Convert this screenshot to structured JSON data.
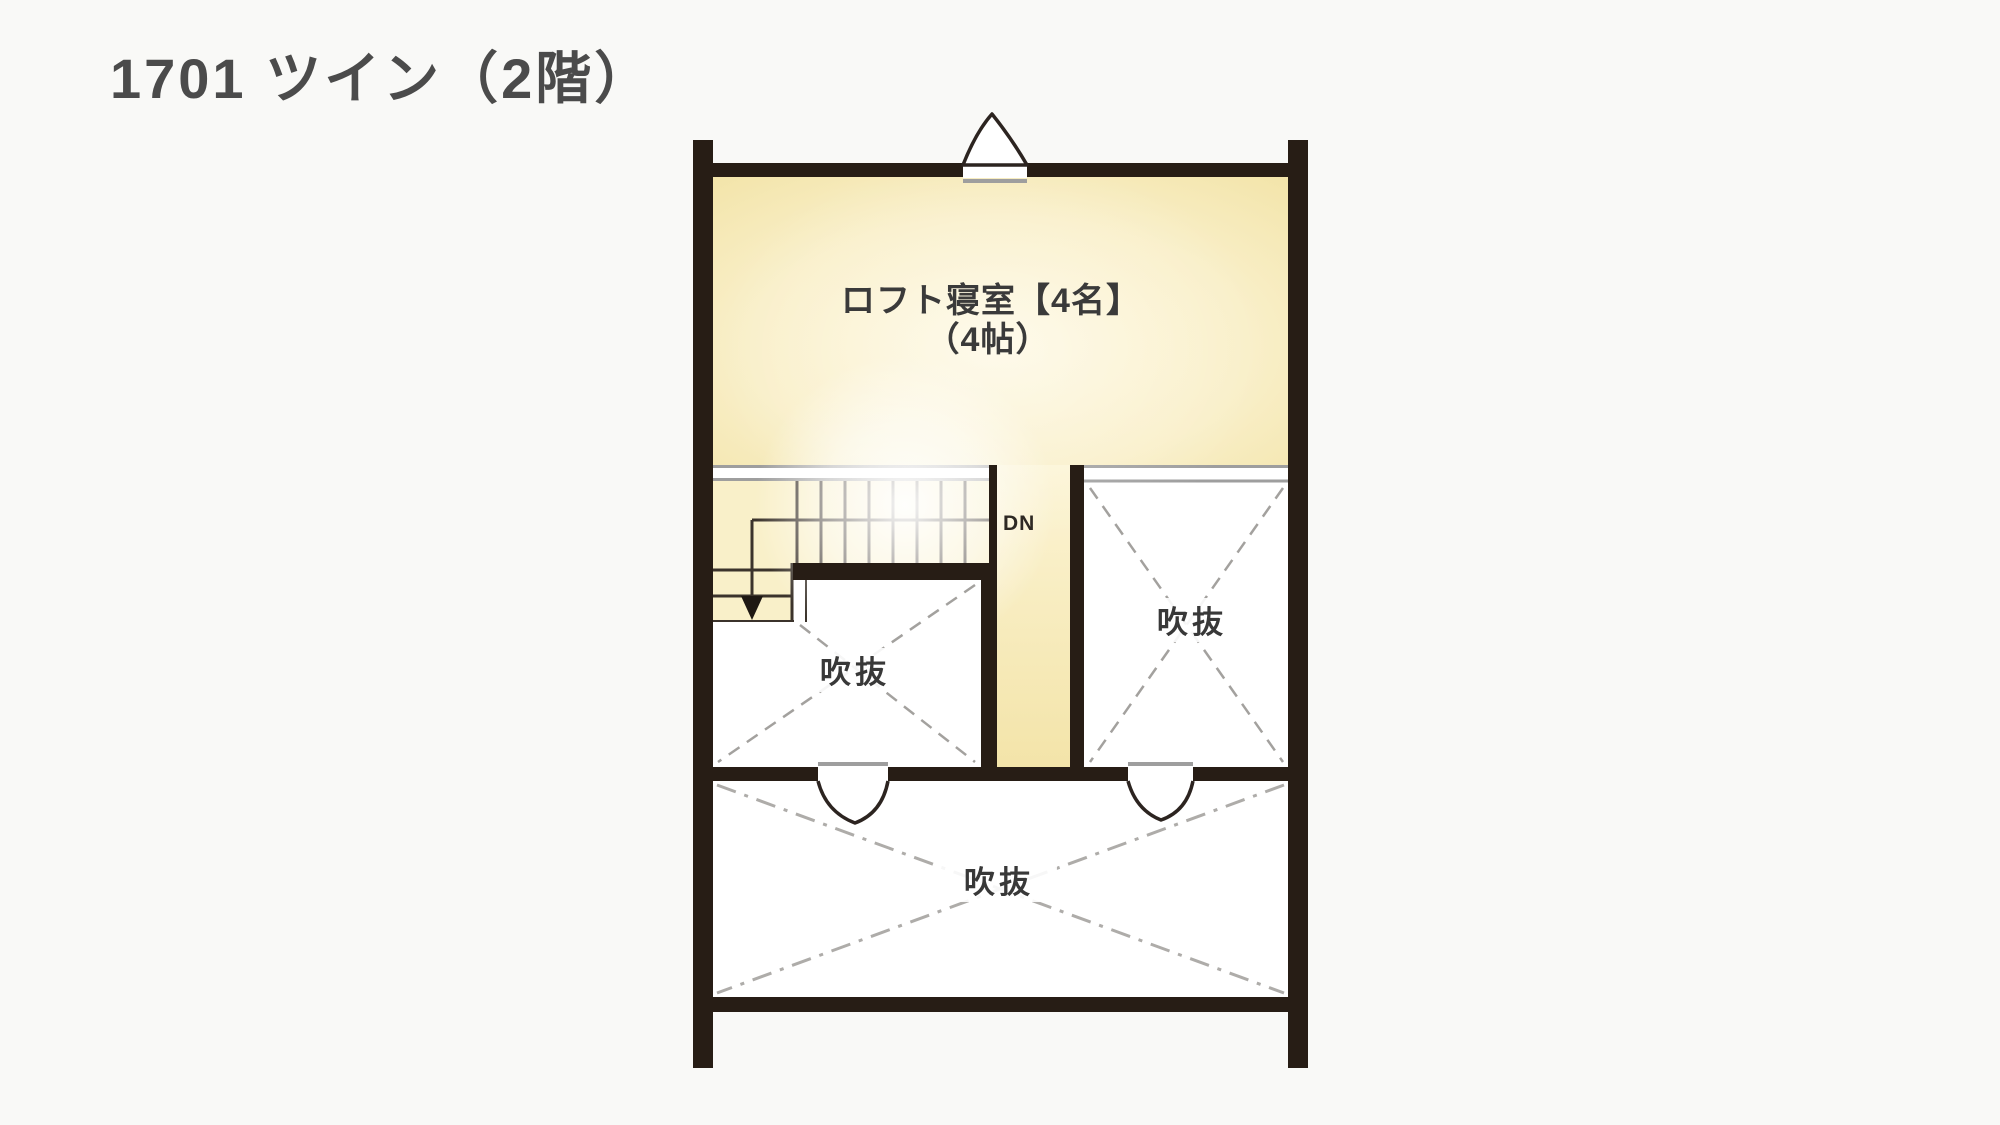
{
  "title": "1701 ツイン（2階）",
  "plan": {
    "loft_room": {
      "name": "ロフト寝室【4名】",
      "size": "（4帖）"
    },
    "stairs": {
      "direction_label": "DN"
    },
    "voids": [
      {
        "location": "left",
        "label": "吹抜"
      },
      {
        "location": "right",
        "label": "吹抜"
      },
      {
        "location": "bottom",
        "label": "吹抜"
      }
    ],
    "doors": [
      {
        "location": "top-wall",
        "type": "swing-out"
      },
      {
        "location": "middle-wall-left",
        "type": "swing-down"
      },
      {
        "location": "middle-wall-right",
        "type": "swing-down"
      }
    ]
  },
  "colors": {
    "background": "#f9f9f7",
    "wall": "#271d15",
    "room_yellow_edge": "#f4e6ae",
    "room_yellow_center": "#fdf6da",
    "void_white": "#ffffff",
    "gray_line": "#9e9e9e",
    "dash_line": "#a3a19e",
    "title_text": "#4b4b4b",
    "label_text": "#3a3a3a"
  }
}
